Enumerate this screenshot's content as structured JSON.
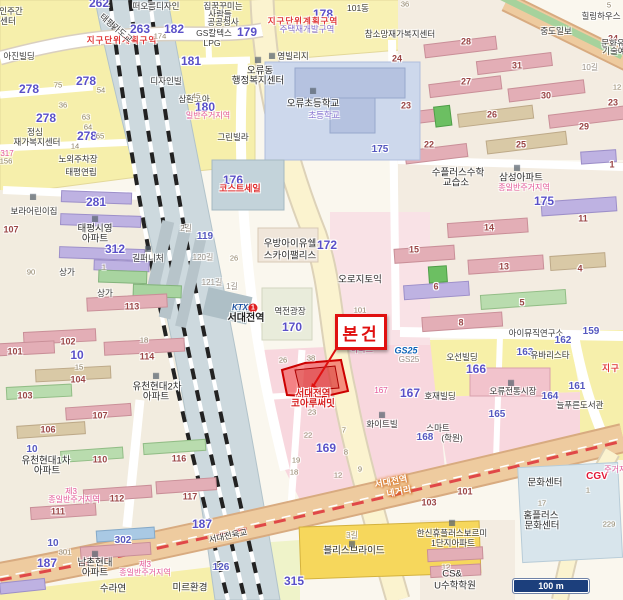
{
  "callout": {
    "label": "본건"
  },
  "scalebar": {
    "label": "100 m"
  },
  "subject": {
    "name_line1": "서대전역",
    "name_line2": "코아루써밋"
  },
  "station": {
    "brand": "KTX",
    "line": "1",
    "name": "서대전역"
  },
  "colors": {
    "parcel_highlight": "#e83636",
    "callout_red": "#e01010",
    "block_number_purple": "#5a50c8",
    "row_number_brown": "#9a4545",
    "zone_red": "#e03838",
    "zone_pink": "#e4569a",
    "railway_band": "#cdd9de",
    "artery": "#eecb9f",
    "boulevard": "#fbf3cf",
    "scalebar_navy": "#1c3f7c"
  },
  "labels": [
    {
      "t": "262",
      "x": 99,
      "y": 3,
      "c": "num"
    },
    {
      "t": "263",
      "x": 140,
      "y": 29,
      "c": "num"
    },
    {
      "t": "지구단위계획구역",
      "x": 122,
      "y": 40,
      "c": "zr"
    },
    {
      "t": "인주간",
      "x": 11,
      "y": 11,
      "c": "nm"
    },
    {
      "t": "센터",
      "x": 8,
      "y": 21,
      "c": "nm"
    },
    {
      "t": "아진빌딩",
      "x": 19,
      "y": 56,
      "c": "nm"
    },
    {
      "t": "278",
      "x": 86,
      "y": 81,
      "c": "num"
    },
    {
      "t": "278",
      "x": 29,
      "y": 89,
      "c": "num"
    },
    {
      "t": "278",
      "x": 46,
      "y": 118,
      "c": "num"
    },
    {
      "t": "278",
      "x": 87,
      "y": 136,
      "c": "num"
    },
    {
      "t": "65",
      "x": 100,
      "y": 136,
      "c": "sm"
    },
    {
      "t": "54",
      "x": 101,
      "y": 90,
      "c": "sm"
    },
    {
      "t": "36",
      "x": 63,
      "y": 105,
      "c": "sm"
    },
    {
      "t": "63",
      "x": 86,
      "y": 117,
      "c": "sm"
    },
    {
      "t": "64",
      "x": 88,
      "y": 127,
      "c": "sm"
    },
    {
      "t": "75",
      "x": 58,
      "y": 85,
      "c": "sm"
    },
    {
      "t": "14",
      "x": 75,
      "y": 146,
      "c": "sm"
    },
    {
      "t": "정심",
      "x": 35,
      "y": 132,
      "c": "nm"
    },
    {
      "t": "재가복지센터",
      "x": 37,
      "y": 142,
      "c": "nm"
    },
    {
      "t": "317",
      "x": 7,
      "y": 154,
      "c": "zp"
    },
    {
      "t": "156",
      "x": 6,
      "y": 161,
      "c": "sm"
    },
    {
      "t": "노외주차장",
      "x": 78,
      "y": 159,
      "c": "nm"
    },
    {
      "t": "태평연립",
      "x": 81,
      "y": 172,
      "c": "nm"
    },
    {
      "t": "태평가도교",
      "x": 116,
      "y": 28,
      "c": "nm",
      "r": 40
    },
    {
      "t": "174",
      "x": 160,
      "y": 36,
      "c": "sm"
    },
    {
      "t": "떠오름디자인",
      "x": 156,
      "y": 6,
      "c": "nm"
    },
    {
      "t": "디자인빌",
      "x": 166,
      "y": 81,
      "c": "nm"
    },
    {
      "t": "181",
      "x": 191,
      "y": 61,
      "c": "num"
    },
    {
      "t": "182",
      "x": 174,
      "y": 29,
      "c": "num"
    },
    {
      "t": "GS칼텍스",
      "x": 214,
      "y": 33,
      "c": "nm"
    },
    {
      "t": "LPG",
      "x": 212,
      "y": 43,
      "c": "nm"
    },
    {
      "t": "삼환코아",
      "x": 194,
      "y": 99,
      "c": "nm"
    },
    {
      "t": "180",
      "x": 205,
      "y": 107,
      "c": "num"
    },
    {
      "t": "일반주거지역",
      "x": 208,
      "y": 116,
      "c": "zp"
    },
    {
      "t": "45",
      "x": 196,
      "y": 96,
      "c": "sm"
    },
    {
      "t": "그린빌라",
      "x": 233,
      "y": 137,
      "c": "nm"
    },
    {
      "t": "176",
      "x": 233,
      "y": 180,
      "c": "num"
    },
    {
      "t": "코스트세일",
      "x": 240,
      "y": 189,
      "c": "brr"
    },
    {
      "t": "119",
      "x": 205,
      "y": 237,
      "c": "num2"
    },
    {
      "t": "2길",
      "x": 186,
      "y": 229,
      "c": "rd"
    },
    {
      "t": "120길",
      "x": 203,
      "y": 258,
      "c": "rd"
    },
    {
      "t": "26",
      "x": 234,
      "y": 258,
      "c": "sm"
    },
    {
      "t": "121길",
      "x": 212,
      "y": 283,
      "c": "rd"
    },
    {
      "t": "1길",
      "x": 232,
      "y": 287,
      "c": "rd"
    },
    {
      "t": "집꿈꾸미는",
      "x": 223,
      "y": 6,
      "c": "nm"
    },
    {
      "t": "사람들",
      "x": 220,
      "y": 14,
      "c": "nm"
    },
    {
      "t": "공공청사",
      "x": 223,
      "y": 22,
      "c": "nm"
    },
    {
      "t": "179",
      "x": 247,
      "y": 32,
      "c": "num"
    },
    {
      "t": "178",
      "x": 323,
      "y": 14,
      "c": "num"
    },
    {
      "t": "101동",
      "x": 358,
      "y": 8,
      "c": "nm"
    },
    {
      "t": "지구단위계획구역",
      "x": 303,
      "y": 21,
      "c": "zr"
    },
    {
      "t": "주택재개발구역",
      "x": 307,
      "y": 29,
      "c": "zv"
    },
    {
      "t": "참소망재가복지센터",
      "x": 400,
      "y": 34,
      "c": "nm"
    },
    {
      "t": "영빌리지",
      "x": 293,
      "y": 56,
      "c": "nm"
    },
    {
      "t": "오류동",
      "x": 260,
      "y": 71,
      "c": "nm2"
    },
    {
      "t": "행정복지센터",
      "x": 258,
      "y": 81,
      "c": "nm2"
    },
    {
      "t": "오류초등학교",
      "x": 313,
      "y": 104,
      "c": "nm2"
    },
    {
      "t": "초등학교",
      "x": 324,
      "y": 115,
      "c": "zv"
    },
    {
      "t": "175",
      "x": 380,
      "y": 150,
      "c": "num2"
    },
    {
      "t": "36",
      "x": 405,
      "y": 4,
      "c": "sm"
    },
    {
      "t": "5",
      "x": 609,
      "y": 5,
      "c": "sm"
    },
    {
      "t": "28",
      "x": 466,
      "y": 42,
      "c": "bn"
    },
    {
      "t": "24",
      "x": 397,
      "y": 59,
      "c": "bn"
    },
    {
      "t": "24",
      "x": 613,
      "y": 39,
      "c": "bn"
    },
    {
      "t": "31",
      "x": 517,
      "y": 66,
      "c": "bn"
    },
    {
      "t": "27",
      "x": 466,
      "y": 82,
      "c": "bn"
    },
    {
      "t": "30",
      "x": 546,
      "y": 96,
      "c": "bn"
    },
    {
      "t": "23",
      "x": 406,
      "y": 106,
      "c": "bn"
    },
    {
      "t": "23",
      "x": 613,
      "y": 103,
      "c": "bn"
    },
    {
      "t": "26",
      "x": 492,
      "y": 115,
      "c": "bn"
    },
    {
      "t": "29",
      "x": 584,
      "y": 127,
      "c": "bn"
    },
    {
      "t": "22",
      "x": 429,
      "y": 145,
      "c": "bn"
    },
    {
      "t": "25",
      "x": 521,
      "y": 145,
      "c": "bn"
    },
    {
      "t": "중도일보",
      "x": 556,
      "y": 31,
      "c": "nm"
    },
    {
      "t": "힐링하우스",
      "x": 601,
      "y": 16,
      "c": "nm"
    },
    {
      "t": "문화유",
      "x": 613,
      "y": 43,
      "c": "nm"
    },
    {
      "t": "기술예",
      "x": 614,
      "y": 51,
      "c": "nm"
    },
    {
      "t": "10길",
      "x": 590,
      "y": 68,
      "c": "rd"
    },
    {
      "t": "12",
      "x": 617,
      "y": 87,
      "c": "sm"
    },
    {
      "t": "수플러스수학",
      "x": 458,
      "y": 173,
      "c": "nm2"
    },
    {
      "t": "교습소",
      "x": 456,
      "y": 183,
      "c": "nm2"
    },
    {
      "t": "삼성아파트",
      "x": 521,
      "y": 178,
      "c": "nm2"
    },
    {
      "t": "종일반주거지역",
      "x": 524,
      "y": 188,
      "c": "zp"
    },
    {
      "t": "175",
      "x": 544,
      "y": 201,
      "c": "num"
    },
    {
      "t": "1",
      "x": 612,
      "y": 165,
      "c": "bn"
    },
    {
      "t": "11",
      "x": 583,
      "y": 219,
      "c": "bn"
    },
    {
      "t": "14",
      "x": 489,
      "y": 228,
      "c": "bn"
    },
    {
      "t": "15",
      "x": 414,
      "y": 250,
      "c": "bn"
    },
    {
      "t": "13",
      "x": 504,
      "y": 267,
      "c": "bn"
    },
    {
      "t": "4",
      "x": 580,
      "y": 269,
      "c": "bn"
    },
    {
      "t": "6",
      "x": 436,
      "y": 287,
      "c": "bn"
    },
    {
      "t": "5",
      "x": 522,
      "y": 303,
      "c": "bn"
    },
    {
      "t": "8",
      "x": 461,
      "y": 323,
      "c": "bn"
    },
    {
      "t": "아이뮤직연구소",
      "x": 536,
      "y": 333,
      "c": "nm"
    },
    {
      "t": "162",
      "x": 563,
      "y": 341,
      "c": "num2"
    },
    {
      "t": "159",
      "x": 591,
      "y": 332,
      "c": "num2"
    },
    {
      "t": "오선빌딩",
      "x": 462,
      "y": 357,
      "c": "nm"
    },
    {
      "t": "166",
      "x": 476,
      "y": 369,
      "c": "num"
    },
    {
      "t": "163",
      "x": 525,
      "y": 353,
      "c": "num2"
    },
    {
      "t": "유바리스타",
      "x": 550,
      "y": 355,
      "c": "nm"
    },
    {
      "t": "161",
      "x": 577,
      "y": 387,
      "c": "num2"
    },
    {
      "t": "오류전통시장",
      "x": 513,
      "y": 391,
      "c": "nm"
    },
    {
      "t": "164",
      "x": 550,
      "y": 397,
      "c": "num2"
    },
    {
      "t": "늘푸른도서관",
      "x": 580,
      "y": 405,
      "c": "nm"
    },
    {
      "t": "165",
      "x": 497,
      "y": 415,
      "c": "num2"
    },
    {
      "t": "지구",
      "x": 611,
      "y": 368,
      "c": "zr"
    },
    {
      "t": "호재빌딩",
      "x": 440,
      "y": 396,
      "c": "nm"
    },
    {
      "t": "167",
      "x": 410,
      "y": 393,
      "c": "num"
    },
    {
      "t": "167",
      "x": 381,
      "y": 391,
      "c": "zp"
    },
    {
      "t": "화이트빌",
      "x": 382,
      "y": 424,
      "c": "nm"
    },
    {
      "t": "스마트",
      "x": 438,
      "y": 428,
      "c": "nm"
    },
    {
      "t": "168",
      "x": 425,
      "y": 438,
      "c": "num2"
    },
    {
      "t": "(학원)",
      "x": 452,
      "y": 438,
      "c": "nm"
    },
    {
      "t": "우방아이유쉘",
      "x": 290,
      "y": 244,
      "c": "nm2"
    },
    {
      "t": "스카이팰리스",
      "x": 290,
      "y": 256,
      "c": "nm2"
    },
    {
      "t": "172",
      "x": 327,
      "y": 245,
      "c": "num"
    },
    {
      "t": "오로지토익",
      "x": 360,
      "y": 280,
      "c": "nm2"
    },
    {
      "t": "역전광장",
      "x": 290,
      "y": 311,
      "c": "nm"
    },
    {
      "t": "170",
      "x": 292,
      "y": 327,
      "c": "num"
    },
    {
      "t": "KTX",
      "x": 240,
      "y": 308,
      "c": "ktx"
    },
    {
      "t": "1",
      "x": 253,
      "y": 308,
      "c": "ktx1"
    },
    {
      "t": "서대전역",
      "x": 246,
      "y": 319,
      "c": "st"
    },
    {
      "t": "101",
      "x": 360,
      "y": 310,
      "c": "sm"
    },
    {
      "t": "아파트",
      "x": 362,
      "y": 350,
      "c": "zp"
    },
    {
      "t": "GS25",
      "x": 406,
      "y": 351,
      "c": "gs"
    },
    {
      "t": "GS25",
      "x": 409,
      "y": 360,
      "c": "rd"
    },
    {
      "t": "26",
      "x": 283,
      "y": 360,
      "c": "sm"
    },
    {
      "t": "38",
      "x": 311,
      "y": 358,
      "c": "sm"
    },
    {
      "t": "서대전역",
      "x": 313,
      "y": 394,
      "c": "prc"
    },
    {
      "t": "코아루써밋",
      "x": 313,
      "y": 404,
      "c": "prc"
    },
    {
      "t": "169",
      "x": 326,
      "y": 448,
      "c": "num"
    },
    {
      "t": "23",
      "x": 312,
      "y": 412,
      "c": "sm"
    },
    {
      "t": "22",
      "x": 308,
      "y": 435,
      "c": "sm"
    },
    {
      "t": "7",
      "x": 344,
      "y": 430,
      "c": "sm"
    },
    {
      "t": "8",
      "x": 346,
      "y": 452,
      "c": "sm"
    },
    {
      "t": "19",
      "x": 296,
      "y": 460,
      "c": "sm"
    },
    {
      "t": "18",
      "x": 294,
      "y": 472,
      "c": "sm"
    },
    {
      "t": "12",
      "x": 338,
      "y": 475,
      "c": "sm"
    },
    {
      "t": "9",
      "x": 360,
      "y": 469,
      "c": "sm"
    },
    {
      "t": "서대전역",
      "x": 391,
      "y": 482,
      "c": "xr",
      "r": -11
    },
    {
      "t": "네거리",
      "x": 399,
      "y": 492,
      "c": "xr",
      "r": -11
    },
    {
      "t": "서대전육교",
      "x": 228,
      "y": 536,
      "c": "nm",
      "r": -12
    },
    {
      "t": "3길",
      "x": 352,
      "y": 536,
      "c": "rd"
    },
    {
      "t": "블리스브라이드",
      "x": 354,
      "y": 551,
      "c": "nm2"
    },
    {
      "t": "315",
      "x": 294,
      "y": 581,
      "c": "num"
    },
    {
      "t": "수라연",
      "x": 113,
      "y": 589,
      "c": "nm2"
    },
    {
      "t": "미르환경",
      "x": 190,
      "y": 588,
      "c": "nm2"
    },
    {
      "t": "126",
      "x": 221,
      "y": 568,
      "c": "num2"
    },
    {
      "t": "남촌현대",
      "x": 95,
      "y": 563,
      "c": "nm2"
    },
    {
      "t": "아파트",
      "x": 95,
      "y": 573,
      "c": "nm2"
    },
    {
      "t": "제3",
      "x": 145,
      "y": 565,
      "c": "zp"
    },
    {
      "t": "종일반주거지역",
      "x": 145,
      "y": 573,
      "c": "zp"
    },
    {
      "t": "187",
      "x": 47,
      "y": 563,
      "c": "num"
    },
    {
      "t": "187",
      "x": 202,
      "y": 524,
      "c": "num"
    },
    {
      "t": "10",
      "x": 53,
      "y": 544,
      "c": "num2"
    },
    {
      "t": "301",
      "x": 65,
      "y": 552,
      "c": "sm"
    },
    {
      "t": "302",
      "x": 123,
      "y": 541,
      "c": "num2"
    },
    {
      "t": "106",
      "x": 48,
      "y": 430,
      "c": "bn"
    },
    {
      "t": "107",
      "x": 100,
      "y": 416,
      "c": "bn"
    },
    {
      "t": "110",
      "x": 100,
      "y": 460,
      "c": "bn"
    },
    {
      "t": "116",
      "x": 179,
      "y": 459,
      "c": "bn"
    },
    {
      "t": "112",
      "x": 117,
      "y": 499,
      "c": "bn"
    },
    {
      "t": "111",
      "x": 58,
      "y": 512,
      "c": "bn"
    },
    {
      "t": "117",
      "x": 190,
      "y": 497,
      "c": "bn"
    },
    {
      "t": "10",
      "x": 32,
      "y": 450,
      "c": "num2"
    },
    {
      "t": "유천현대1차",
      "x": 46,
      "y": 461,
      "c": "nm2"
    },
    {
      "t": "아파트",
      "x": 47,
      "y": 471,
      "c": "nm2"
    },
    {
      "t": "제3",
      "x": 71,
      "y": 492,
      "c": "zp"
    },
    {
      "t": "종일반주거지역",
      "x": 74,
      "y": 500,
      "c": "zp"
    },
    {
      "t": "113",
      "x": 132,
      "y": 307,
      "c": "bn"
    },
    {
      "t": "102",
      "x": 68,
      "y": 342,
      "c": "bn"
    },
    {
      "t": "101",
      "x": 15,
      "y": 352,
      "c": "bn"
    },
    {
      "t": "10",
      "x": 77,
      "y": 355,
      "c": "num"
    },
    {
      "t": "15",
      "x": 79,
      "y": 367,
      "c": "sm"
    },
    {
      "t": "104",
      "x": 78,
      "y": 380,
      "c": "bn"
    },
    {
      "t": "103",
      "x": 25,
      "y": 396,
      "c": "bn"
    },
    {
      "t": "114",
      "x": 147,
      "y": 357,
      "c": "bn"
    },
    {
      "t": "18",
      "x": 144,
      "y": 340,
      "c": "sm"
    },
    {
      "t": "유천현대2차",
      "x": 157,
      "y": 387,
      "c": "nm2"
    },
    {
      "t": "아파트",
      "x": 156,
      "y": 397,
      "c": "nm2"
    },
    {
      "t": "90",
      "x": 31,
      "y": 272,
      "c": "sm"
    },
    {
      "t": "상가",
      "x": 67,
      "y": 272,
      "c": "nm"
    },
    {
      "t": "상가",
      "x": 105,
      "y": 293,
      "c": "nm"
    },
    {
      "t": "길퍼니처",
      "x": 148,
      "y": 258,
      "c": "nm"
    },
    {
      "t": "태평시영",
      "x": 95,
      "y": 229,
      "c": "nm2"
    },
    {
      "t": "아파트",
      "x": 95,
      "y": 239,
      "c": "nm2"
    },
    {
      "t": "281",
      "x": 96,
      "y": 202,
      "c": "num"
    },
    {
      "t": "312",
      "x": 115,
      "y": 249,
      "c": "num"
    },
    {
      "t": "1",
      "x": 104,
      "y": 267,
      "c": "sm"
    },
    {
      "t": "보라어린이집",
      "x": 34,
      "y": 211,
      "c": "nm"
    },
    {
      "t": "107",
      "x": 11,
      "y": 230,
      "c": "bn"
    },
    {
      "t": "문화센터",
      "x": 545,
      "y": 483,
      "c": "nm2"
    },
    {
      "t": "17",
      "x": 542,
      "y": 503,
      "c": "sm"
    },
    {
      "t": "홈플러스",
      "x": 541,
      "y": 516,
      "c": "nm2"
    },
    {
      "t": "문화센터",
      "x": 542,
      "y": 526,
      "c": "nm2"
    },
    {
      "t": "CGV",
      "x": 597,
      "y": 477,
      "c": "cgv"
    },
    {
      "t": "주거지역",
      "x": 619,
      "y": 470,
      "c": "zp"
    },
    {
      "t": "1",
      "x": 588,
      "y": 490,
      "c": "sm"
    },
    {
      "t": "229",
      "x": 609,
      "y": 524,
      "c": "sm"
    },
    {
      "t": "103",
      "x": 429,
      "y": 503,
      "c": "bn"
    },
    {
      "t": "101",
      "x": 465,
      "y": 492,
      "c": "bn"
    },
    {
      "t": "한신휴플러스보르미",
      "x": 452,
      "y": 533,
      "c": "nm"
    },
    {
      "t": "1단지아파트",
      "x": 453,
      "y": 543,
      "c": "nm"
    },
    {
      "t": "12",
      "x": 446,
      "y": 567,
      "c": "sm"
    },
    {
      "t": "CS&",
      "x": 452,
      "y": 574,
      "c": "nm2"
    },
    {
      "t": "U수학학원",
      "x": 455,
      "y": 586,
      "c": "nm2"
    },
    {
      "t": "▦",
      "x": 258,
      "y": 60,
      "c": "ic"
    },
    {
      "t": "▦",
      "x": 272,
      "y": 56,
      "c": "ic"
    },
    {
      "t": "▦",
      "x": 313,
      "y": 91,
      "c": "ic"
    },
    {
      "t": "▦",
      "x": 517,
      "y": 168,
      "c": "ic"
    },
    {
      "t": "▦",
      "x": 511,
      "y": 383,
      "c": "ic"
    },
    {
      "t": "▦",
      "x": 95,
      "y": 554,
      "c": "ic"
    },
    {
      "t": "▦",
      "x": 156,
      "y": 376,
      "c": "ic"
    },
    {
      "t": "▦",
      "x": 95,
      "y": 219,
      "c": "ic"
    },
    {
      "t": "▦",
      "x": 148,
      "y": 249,
      "c": "ic"
    },
    {
      "t": "▦",
      "x": 452,
      "y": 523,
      "c": "ic"
    },
    {
      "t": "▦",
      "x": 382,
      "y": 415,
      "c": "ic"
    },
    {
      "t": "▦",
      "x": 352,
      "y": 544,
      "c": "ic"
    },
    {
      "t": "▦",
      "x": 33,
      "y": 197,
      "c": "ic"
    }
  ]
}
